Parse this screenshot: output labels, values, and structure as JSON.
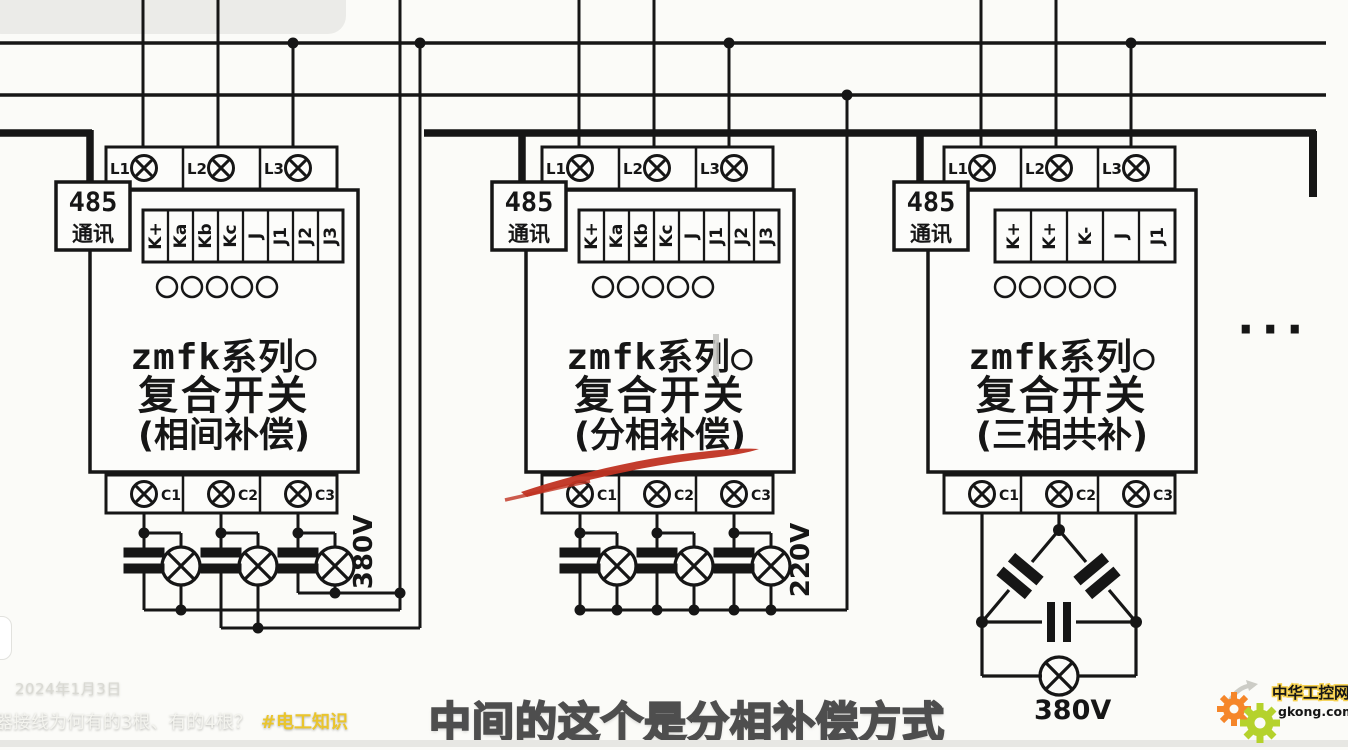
{
  "modules": [
    {
      "name": "module-1-phase-to-phase",
      "comm_line1": "485",
      "comm_line2": "通讯",
      "phase_terminals": [
        "L1",
        "L2",
        "L3"
      ],
      "signal_terminals": [
        "K+",
        "Ka",
        "Kb",
        "Kc",
        "J",
        "J1",
        "J2",
        "J3"
      ],
      "series_title": "zmfk系列○",
      "series_line2": "复合开关",
      "mode": "(相间补偿)",
      "cap_terminals": [
        "C1",
        "C2",
        "C3"
      ],
      "voltage": "380V"
    },
    {
      "name": "module-2-split-phase",
      "comm_line1": "485",
      "comm_line2": "通讯",
      "phase_terminals": [
        "L1",
        "L2",
        "L3"
      ],
      "signal_terminals": [
        "K+",
        "Ka",
        "Kb",
        "Kc",
        "J",
        "J1",
        "J2",
        "J3"
      ],
      "series_title": "zmfk系列○",
      "series_line2": "复合开关",
      "mode": "(分相补偿)",
      "cap_terminals": [
        "C1",
        "C2",
        "C3"
      ],
      "voltage": "220V"
    },
    {
      "name": "module-3-three-phase-common",
      "comm_line1": "485",
      "comm_line2": "通讯",
      "phase_terminals": [
        "L1",
        "L2",
        "L3"
      ],
      "signal_terminals": [
        "K+",
        "K+",
        "K-",
        "J",
        "J1"
      ],
      "series_title": "zmfk系列○",
      "series_line2": "复合开关",
      "mode": "(三相共补)",
      "cap_terminals": [
        "C1",
        "C2",
        "C3"
      ],
      "voltage": "380V"
    }
  ],
  "more_indicator": "···",
  "overlay": {
    "date": "2024年1月3日",
    "question": "器接线为何有的3根、有的4根？",
    "hashtag": "#电工知识",
    "caption": "中间的这个是分相补偿方式"
  },
  "logo": {
    "title": "中华工控网",
    "domain": "gkong.com"
  },
  "colors": {
    "line": "#161616",
    "marker_red": "#c03322",
    "hashtag_yellow": "#eac52c",
    "logo_orange": "#f5862a",
    "logo_green": "#b5d22c"
  }
}
